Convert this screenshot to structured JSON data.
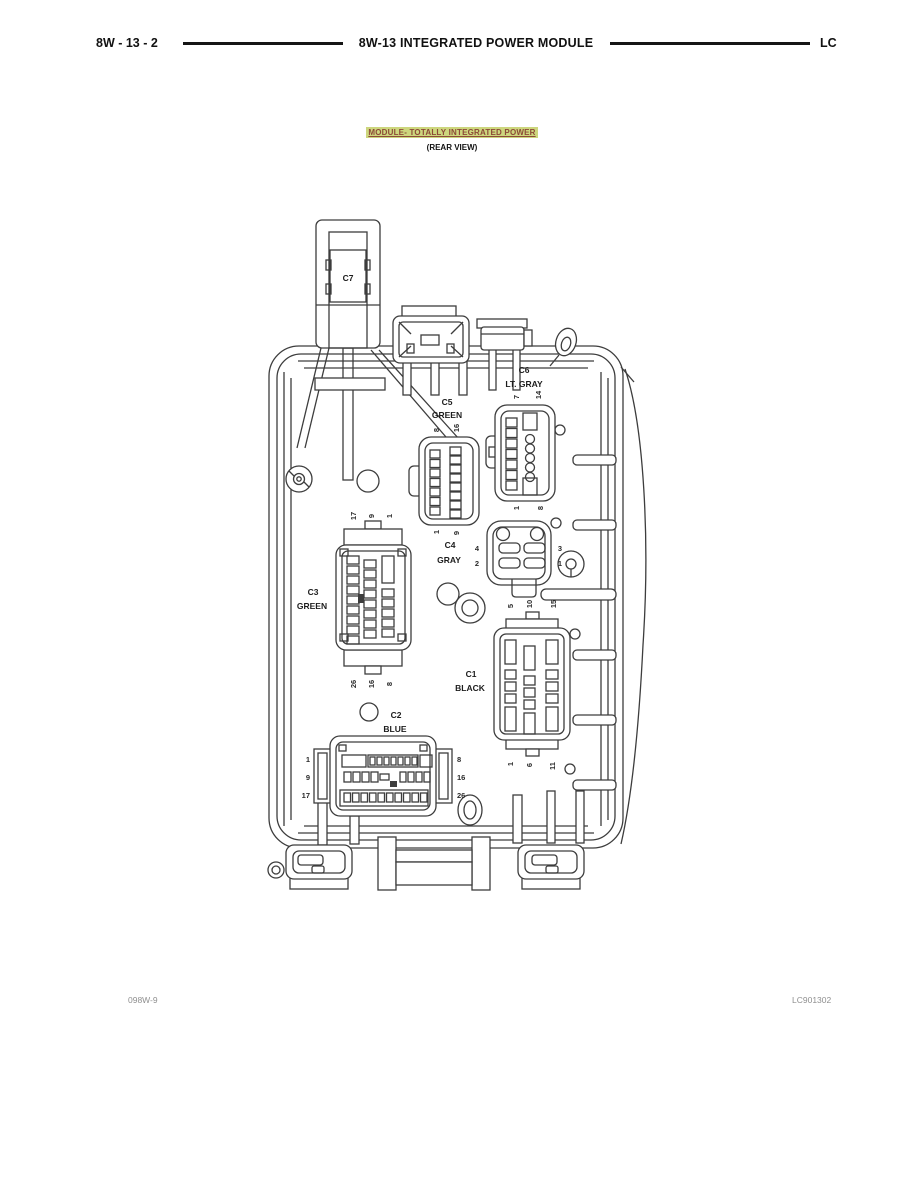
{
  "header": {
    "page_ref": "8W - 13 - 2",
    "title": "8W-13 INTEGRATED POWER MODULE",
    "section": "LC"
  },
  "figure": {
    "title": "MODULE- TOTALLY INTEGRATED POWER",
    "subtitle": "(REAR VIEW)"
  },
  "connectors": {
    "c1": {
      "id": "C1",
      "color_label": "BLACK",
      "pins_top": [
        "5",
        "10",
        "15"
      ],
      "pins_bottom": [
        "1",
        "6",
        "11"
      ]
    },
    "c2": {
      "id": "C2",
      "color_label": "BLUE",
      "pins_left": [
        "1",
        "9",
        "17"
      ],
      "pins_right": [
        "8",
        "16",
        "26"
      ]
    },
    "c3": {
      "id": "C3",
      "color_label": "GREEN",
      "pins_top": [
        "17",
        "9",
        "1"
      ],
      "pins_bottom": [
        "26",
        "16",
        "8"
      ]
    },
    "c4": {
      "id": "C4",
      "color_label": "GRAY",
      "pins_left": [
        "4",
        "2"
      ],
      "pins_right": [
        "3",
        "1"
      ]
    },
    "c5": {
      "id": "C5",
      "color_label": "GREEN",
      "pins_top": [
        "8",
        "16"
      ],
      "pins_bottom": [
        "1",
        "9"
      ]
    },
    "c6": {
      "id": "C6",
      "color_label": "LT. GRAY",
      "pins_top": [
        "7",
        "14"
      ],
      "pins_bottom": [
        "1",
        "8"
      ]
    },
    "c7": {
      "id": "C7"
    }
  },
  "footer": {
    "left_code": "098W-9",
    "right_code": "LC901302"
  },
  "colors": {
    "highlight": "#cdd67d",
    "link_text": "#8c4a38",
    "line": "#3d3d3d"
  }
}
